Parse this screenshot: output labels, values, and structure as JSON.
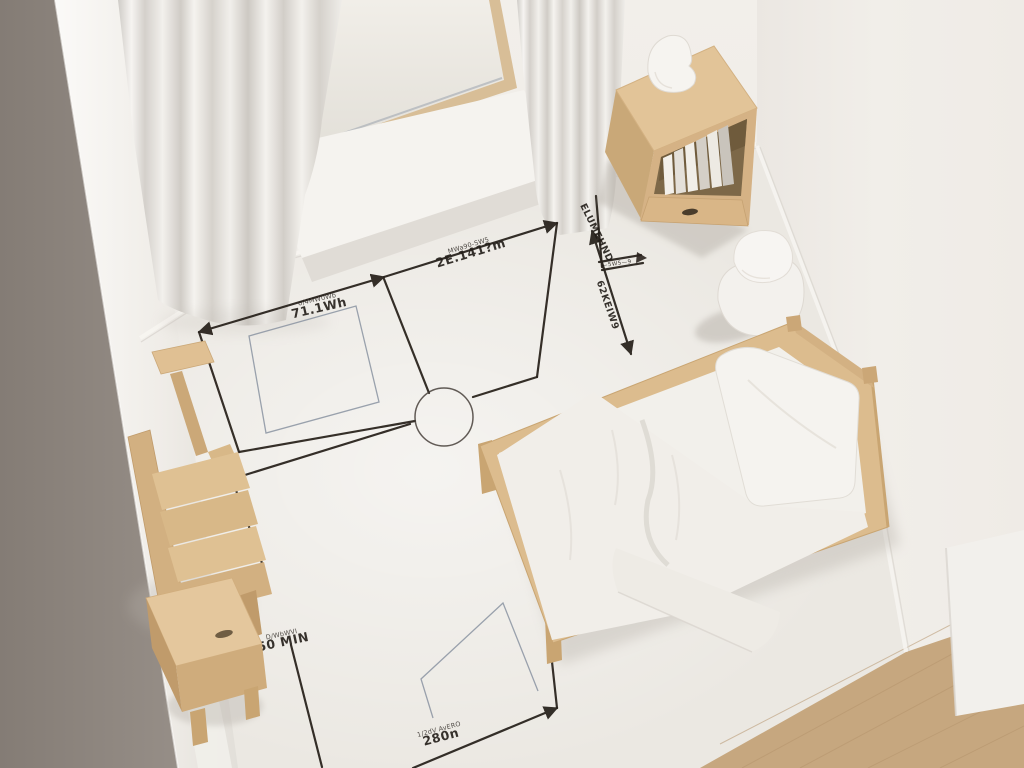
{
  "scene": {
    "description": "Top-down view of a minimalist white bedroom with hand-drawn floor-plan dimension sketch on the floor",
    "room_style": "minimal scandinavian, white walls, light wood furniture"
  },
  "annotations": {
    "pen_color": "#2A241E",
    "thin_line_color": "#8A93A1",
    "labels": [
      {
        "id": "area-left-width",
        "small": "σ/4MW0Wb",
        "text": "71.1Wh"
      },
      {
        "id": "top-width",
        "small": "MWa90-SW5",
        "text": "2Ε.141?m"
      },
      {
        "id": "right-edge",
        "small": "",
        "text": "62KEIW9"
      },
      {
        "id": "nightstand-offset",
        "small": "",
        "text": "ELUMEHND"
      },
      {
        "id": "nightstand-detail",
        "small": "",
        "text": "—5W5—9"
      },
      {
        "id": "left-height",
        "small": "D/WbWVI",
        "text": "50 MIN"
      },
      {
        "id": "bottom-width",
        "small": "1/2dV AvERO",
        "text": "280n"
      }
    ]
  },
  "objects": {
    "window": "wood-framed window with white sill",
    "left_curtain": "white floor-length curtain",
    "right_curtain": "white curtain panel",
    "nightstand": "light wood open shelf cabinet with drawer",
    "books": "stack of white and grey books on shelf",
    "table_lamp": "white ceramic lamp on nightstand",
    "ceramic_stool": "two-tier white ceramic stool",
    "bed": "single light-wood bed with white duvet",
    "pillow": "white pillow",
    "chair": "light wood slatted chair",
    "side_table": "small light wood side table",
    "door_swing_arc": "door swing circle drawn on floor",
    "wood_floor": "light oak flooring strip at lower right"
  },
  "palette": {
    "wall": "#EFECE7",
    "wall_left_band": "#8E8680",
    "floor": "#EAE7E2",
    "wood": "#D9B98C",
    "wood_dark": "#C29E6F",
    "bedding": "#F2F0EC",
    "wood_floor": "#C6A77F",
    "pen": "#2A241E",
    "thin_line": "#8A93A1"
  }
}
